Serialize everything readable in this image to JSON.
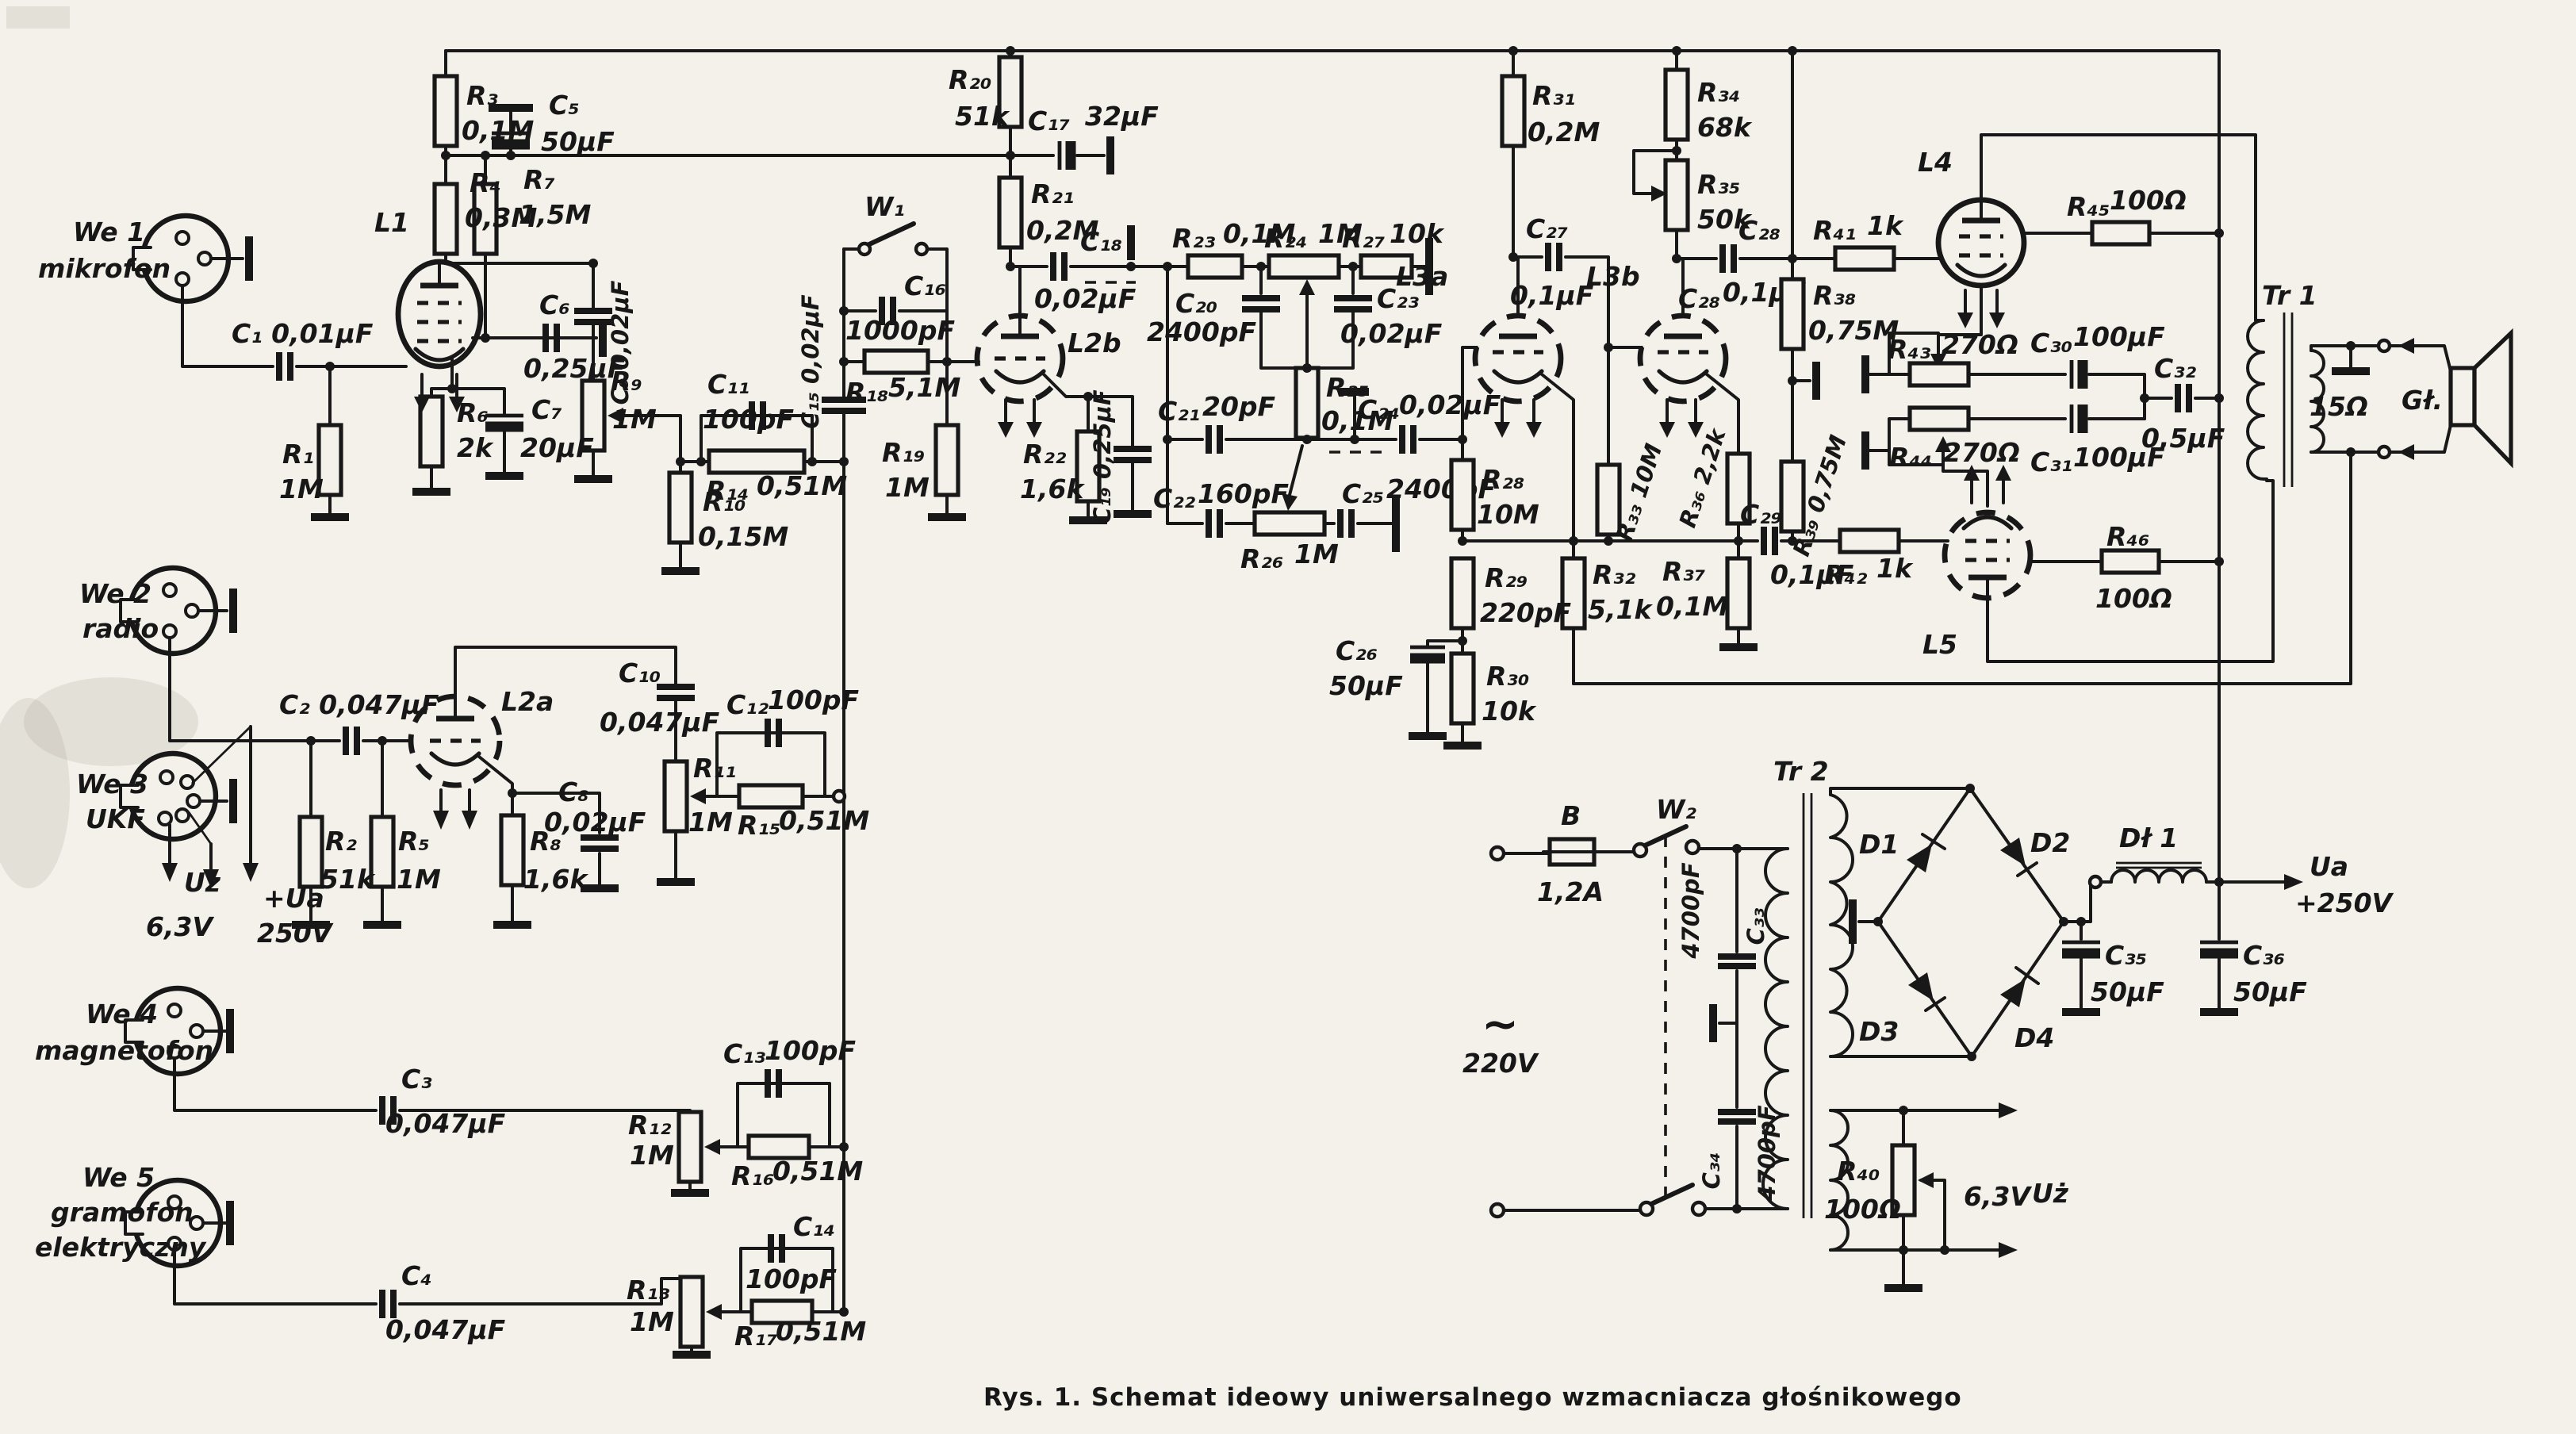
{
  "figure": {
    "caption": "Rys. 1. Schemat ideowy uniwersalnego wzmacniacza głośnikowego",
    "type": "schematic-diagram",
    "subject": "universal loudspeaker amplifier (tube amplifier), Polish magazine figure"
  },
  "colors": {
    "paper": "#f3f1ea",
    "ink": "#181818"
  },
  "labels": {
    "we1a": "We 1",
    "we1b": "mikrofon",
    "we2a": "We 2",
    "we2b": "radio",
    "we3a": "We 3",
    "we3b": "UKF",
    "we4a": "We 4",
    "we4b": "magnetofon",
    "we5a": "We 5",
    "we5b": "gramofon",
    "we5c": "elektryczny",
    "c1": "C₁ 0,01μF",
    "r1a": "R₁",
    "r1b": "1M",
    "l1": "L1",
    "r3a": "R₃",
    "r3b": "0,1M",
    "c5a": "C₅",
    "c5b": "50μF",
    "r4a": "R₄",
    "r4b": "0,3M",
    "r7a": "R₇",
    "r7b": "1,5M",
    "c6a": "C₆",
    "c6b": "0,25μF",
    "c9": "C₉ 0,02μF",
    "r6a": "R₆",
    "r6b": "2k",
    "c7a": "C₇",
    "c7b": "20μF",
    "r9a": "R₉",
    "r9b": "1M",
    "c11a": "C₁₁",
    "c11b": "100pF",
    "r14a": "R₁₄",
    "r14b": "0,51M",
    "r10a": "R₁₀",
    "r10b": "0,15M",
    "c15": "C₁₅ 0,02μF",
    "w1": "W₁",
    "c16a": "C₁₆",
    "c16b": "1000pF",
    "r18a": "R₁₈",
    "r18b": "5,1M",
    "r19a": "R₁₉",
    "r19b": "1M",
    "l2b": "L2b",
    "r22a": "R₂₂",
    "r22b": "1,6k",
    "c19": "C₁₉ 0,25μF",
    "r20a": "R₂₀",
    "r20b": "51k",
    "c17a": "C₁₇",
    "c17b": "32μF",
    "r21a": "R₂₁",
    "r21b": "0,2M",
    "c18a": "C₁₈",
    "c18b": "0,02μF",
    "r23a": "R₂₃",
    "r23b": "0,1M",
    "r24a": "R₂₄",
    "r24b": "1M",
    "r27a": "R₂₇",
    "r27b": "10k",
    "c20a": "C₂₀",
    "c20b": "2400pF",
    "c23a": "C₂₃",
    "c23b": "0,02μF",
    "r25a": "R₂₅",
    "r25b": "0,1M",
    "c21a": "C₂₁",
    "c21b": "20pF",
    "c24a": "C₂₄",
    "c24b": "0,02μF",
    "c22a": "C₂₂",
    "c22b": "160pF",
    "c25a": "C₂₅",
    "c25b": "2400pF",
    "r26a": "R₂₆",
    "r26b": "1M",
    "l3a": "L3a",
    "l3b": "L3b",
    "c27a": "C₂₇",
    "c27b": "0,1μF",
    "r31a": "R₃₁",
    "r31b": "0,2M",
    "r34a": "R₃₄",
    "r34b": "68k",
    "r35a": "R₃₅",
    "r35b": "50k",
    "c28a": "C₂₈",
    "c28b": "C₂₈",
    "c28c": "0,1μF",
    "r38a": "R₃₈",
    "r38b": "0,75M",
    "r33": "R₃₃ 10M",
    "r36": "R₃₆ 2,2k",
    "r39": "R₃₉ 0,75M",
    "c29a": "C₂₉",
    "c29b": "0,1μF",
    "r37a": "R₃₇",
    "r37b": "0,1M",
    "r28a": "R₂₈",
    "r28b": "10M",
    "r29a": "R₂₉",
    "r29b": "220pF",
    "r30a": "R₃₀",
    "r30b": "10k",
    "c26a": "C₂₆",
    "c26b": "50μF",
    "r32a": "R₃₂",
    "r32b": "5,1k",
    "r41a": "R₄₁",
    "r41b": "1k",
    "r42a": "R₄₂",
    "r42b": "1k",
    "l4": "L4",
    "l5": "L5",
    "r45a": "R₄₅",
    "r45b": "100Ω",
    "r46a": "R₄₆",
    "r46b": "100Ω",
    "r43a": "R₄₃",
    "r43b": "270Ω",
    "r44a": "R₄₄",
    "r44b": "270Ω",
    "c30a": "C₃₀",
    "c30b": "100μF",
    "c31a": "C₃₁",
    "c31b": "100μF",
    "c32a": "C₃₂",
    "c32b": "0,5μF",
    "tr1": "Tr 1",
    "ohm15": "15Ω",
    "gl": "Gł.",
    "uz1": "Uż",
    "v63a": "6,3V",
    "ua1a": "+Ua",
    "ua1b": "250V",
    "c2": "C₂ 0,047μF",
    "l2a": "L2a",
    "r2a": "R₂",
    "r2b": "51k",
    "r5a": "R₅",
    "r5b": "1M",
    "r8a": "R₈",
    "r8b": "1,6k",
    "c8a": "C₈",
    "c8b": "0,02μF",
    "c10a": "C₁₀",
    "c10b": "0,047μF",
    "r11a": "R₁₁",
    "r11b": "1M",
    "c12a": "C₁₂",
    "c12b": "100pF",
    "r15a": "R₁₅",
    "r15b": "0,51M",
    "c3a": "C₃",
    "c3b": "0,047μF",
    "c4a": "C₄",
    "c4b": "0,047μF",
    "c13a": "C₁₃",
    "c13b": "100pF",
    "r12a": "R₁₂",
    "r12b": "1M",
    "r16a": "R₁₆",
    "r16b": "0,51M",
    "c14a": "C₁₄",
    "c14b": "100pF",
    "r13a": "R₁₃",
    "r13b": "1M",
    "r17a": "R₁₇",
    "r17b": "0,51M",
    "b_a": "B",
    "b_b": "1,2A",
    "w2": "W₂",
    "tilde": "~",
    "v220": "220V",
    "c33a": "C₃₃",
    "c33b": "4700pF",
    "c34a": "C₃₄",
    "c34b": "4700pF",
    "tr2": "Tr 2",
    "d1": "D1",
    "d2": "D2",
    "d3": "D3",
    "d4": "D4",
    "dl1": "Dł 1",
    "c35a": "C₃₅",
    "c35b": "50μF",
    "c36a": "C₃₆",
    "c36b": "50μF",
    "ua2a": "Ua",
    "ua2b": "+250V",
    "r40a": "R₄₀",
    "r40b": "100Ω",
    "v63b": "6,3V",
    "uz2": "Uż"
  }
}
